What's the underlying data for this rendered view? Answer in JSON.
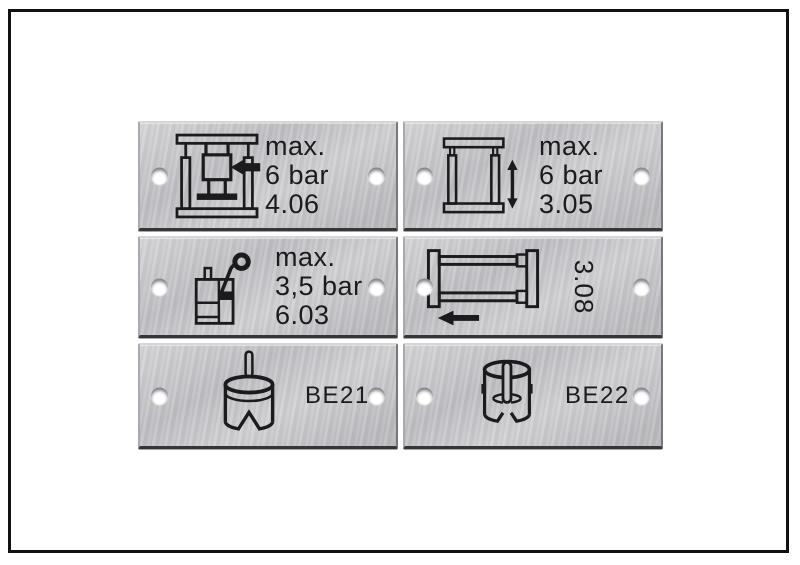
{
  "plates": [
    {
      "name": "press-max-pressure-label",
      "icon": "press-clamp-arrow-icon",
      "lines": [
        "max.",
        "6 bar",
        "4.06"
      ]
    },
    {
      "name": "frame-vertical-travel-label",
      "icon": "frame-vertical-arrow-icon",
      "lines": [
        "max.",
        "6 bar",
        "3.05"
      ]
    },
    {
      "name": "lubricator-max-pressure-label",
      "icon": "tank-gauge-icon",
      "lines": [
        "max.",
        "3,5 bar",
        "6.03"
      ]
    },
    {
      "name": "slide-unit-label",
      "icon": "frame-left-arrow-icon",
      "rotated_label": "3.08"
    },
    {
      "name": "be21-label",
      "icon": "cylinder-rod-icon",
      "label": "BE21"
    },
    {
      "name": "be22-label",
      "icon": "cylinder-pin-icon",
      "label": "BE22"
    }
  ],
  "colors": {
    "background": "#ffffff",
    "frame_border": "#111111",
    "plate": "#c6c6ca",
    "plate_edge_dark": "#35353a",
    "marking": "#1b1b1d"
  }
}
